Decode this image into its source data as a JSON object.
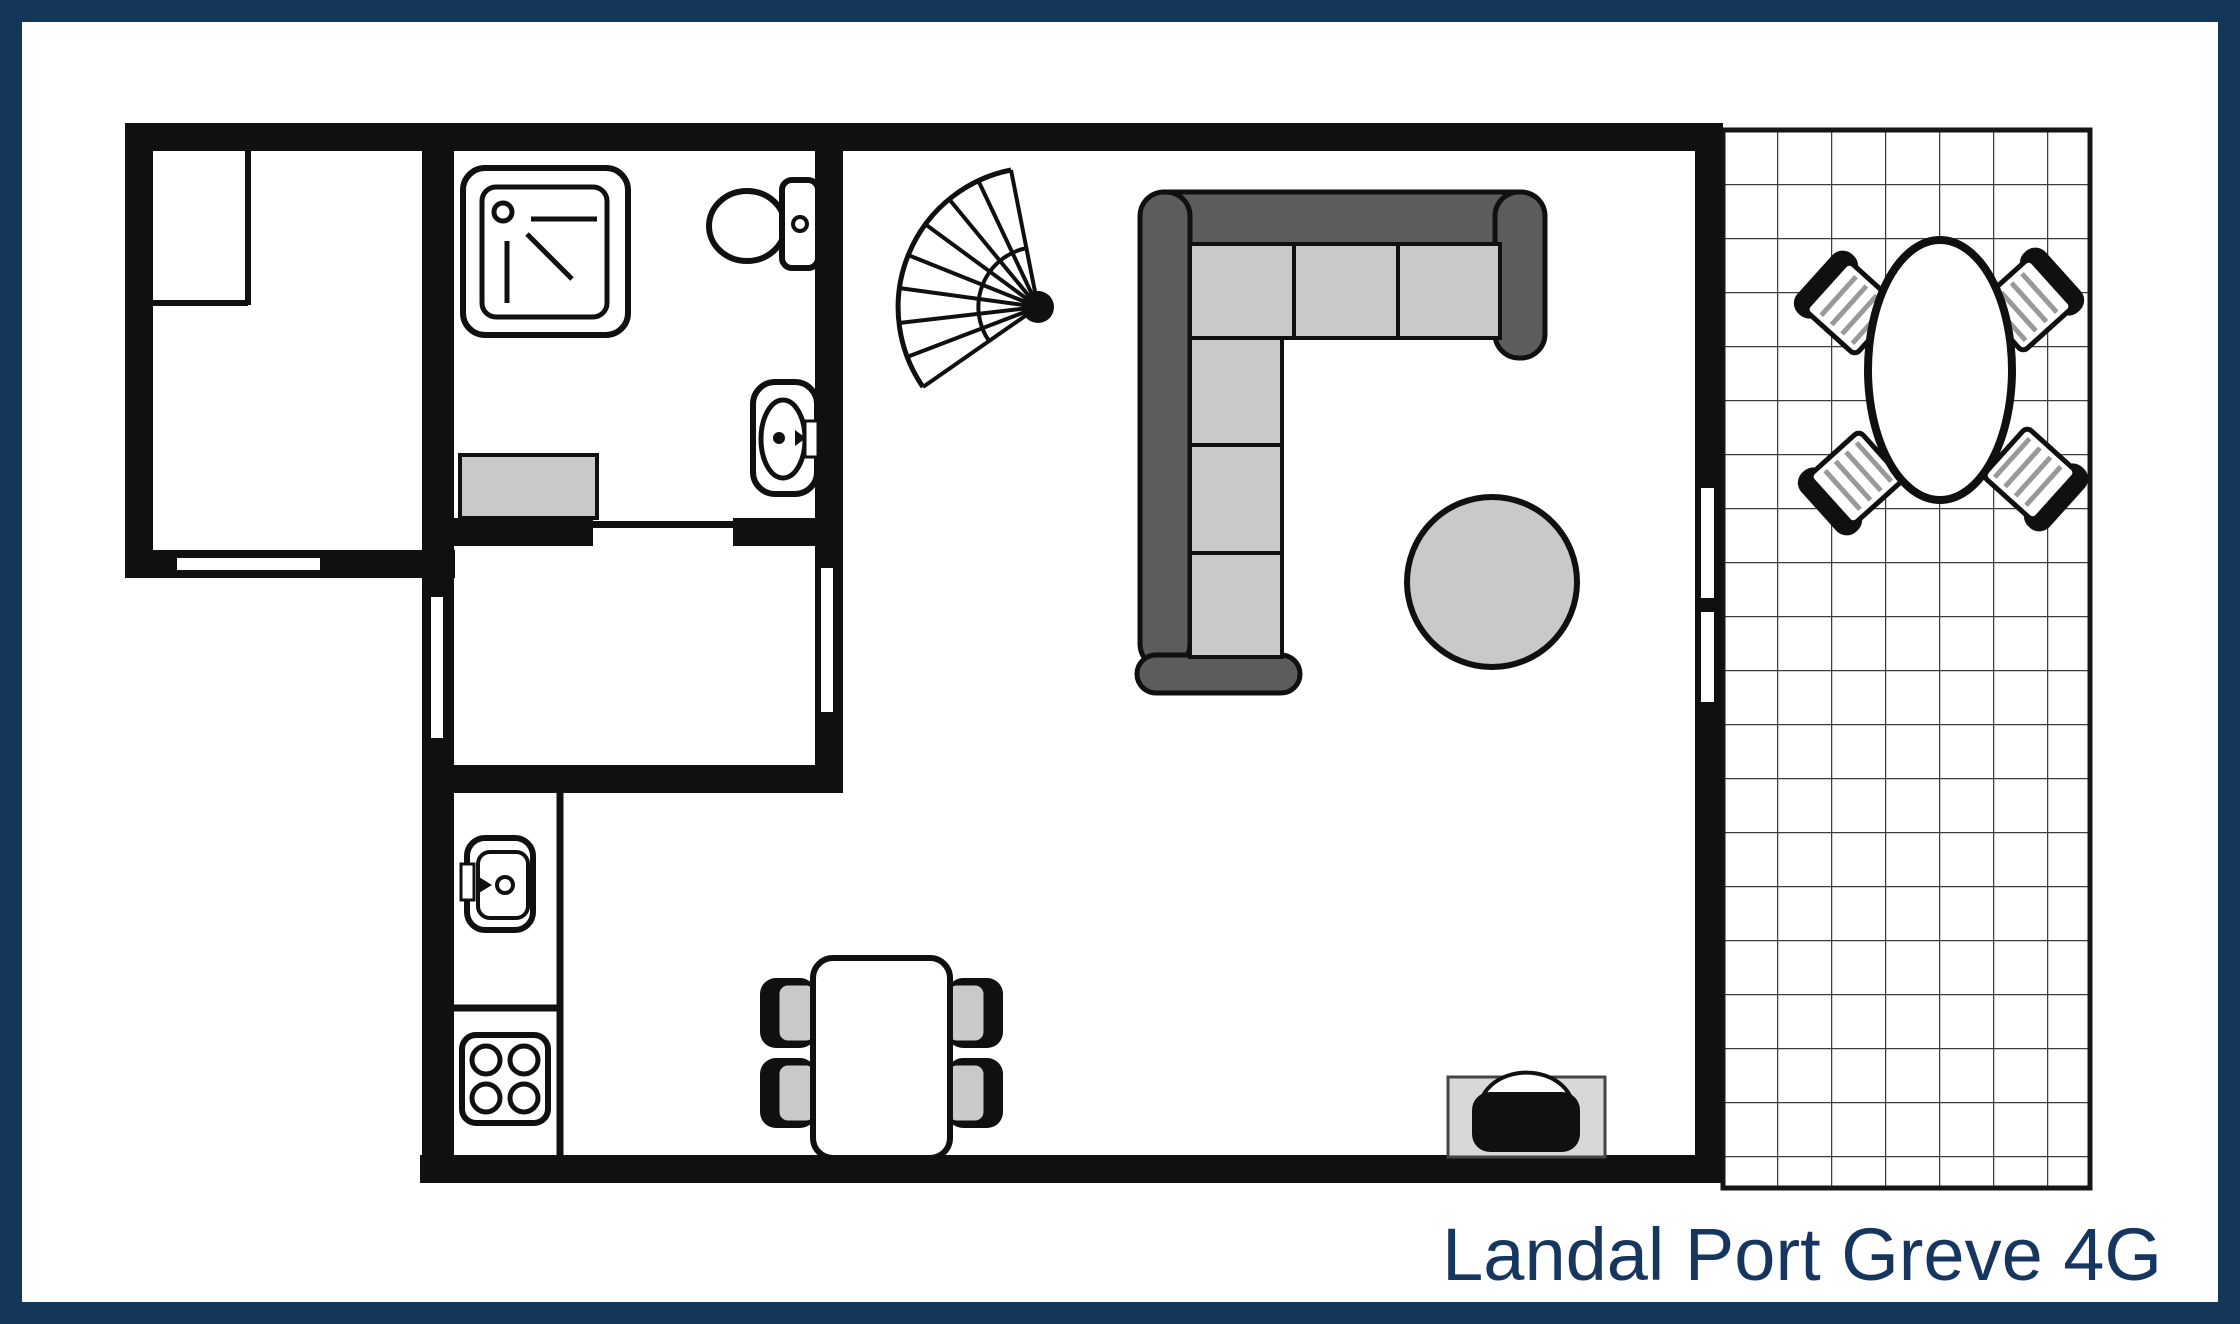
{
  "title": {
    "text": "Landal Port Greve 4G"
  },
  "colors": {
    "frame_navy": "#143659",
    "title_navy": "#16365f",
    "wall_black": "#101010",
    "paper_white": "#ffffff",
    "furniture_gray": "#c9c9c9",
    "sofa_dark": "#5c5c5c",
    "tv_stand_gray": "#d8d8d8",
    "grid_line": "#3d3d3d",
    "stripe_gray": "#999999"
  },
  "legend": {
    "symbols": [
      "shower-icon",
      "toilet-icon",
      "washbasin-icon",
      "spiral-staircase-icon",
      "corner-sofa-icon",
      "side-table-icon",
      "tv-icon",
      "dining-table-icon",
      "dining-chair-icon",
      "kitchen-sink-icon",
      "stove-icon",
      "patio-table-icon",
      "patio-chair-icon",
      "tiled-terrace",
      "window-slit",
      "door-opening"
    ]
  }
}
